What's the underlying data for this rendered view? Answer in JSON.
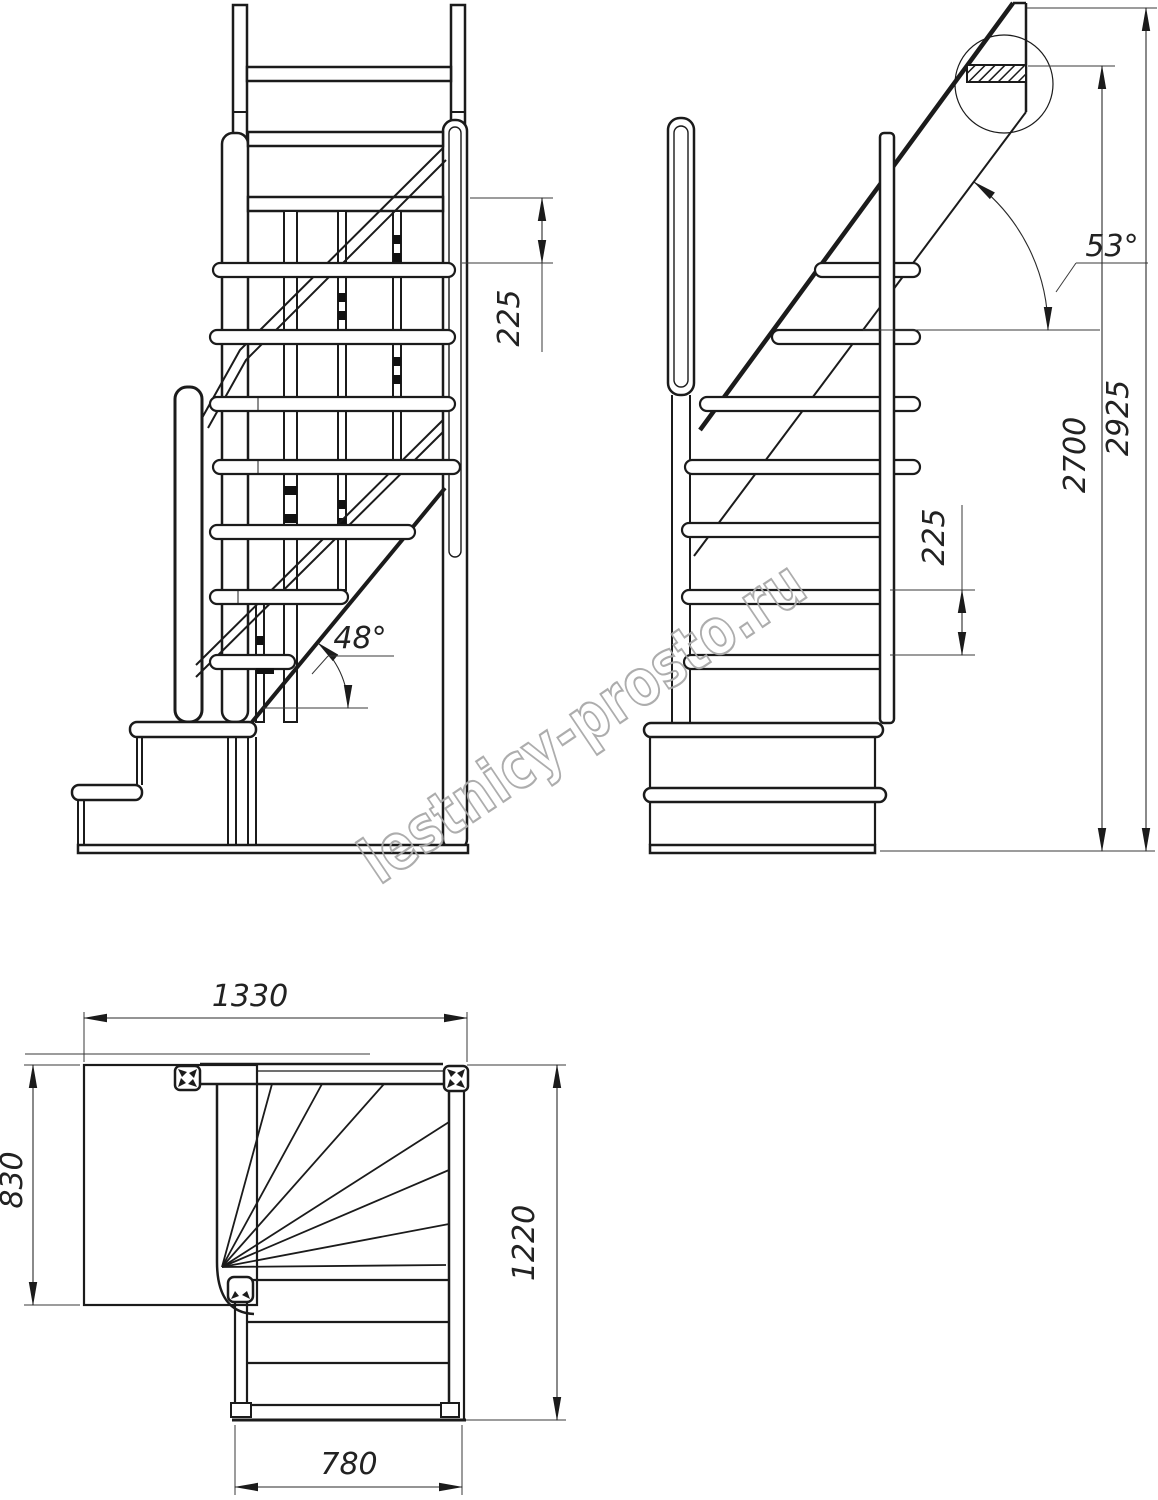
{
  "drawing_type": "staircase technical drawing, three orthographic views",
  "labels": {
    "front_rise": "225",
    "front_angle": "48°",
    "side_angle": "53°",
    "side_rise": "225",
    "side_height_floor": "2700",
    "side_height_total": "2925",
    "plan_width_top": "1330",
    "plan_depth_left": "830",
    "plan_length_right": "1220",
    "plan_width_bottom": "780"
  },
  "watermark": {
    "text": "lestnicy-prosto.ru",
    "color": "#a9a9a9"
  },
  "line_color": "#1b1b1b",
  "background": "#ffffff"
}
